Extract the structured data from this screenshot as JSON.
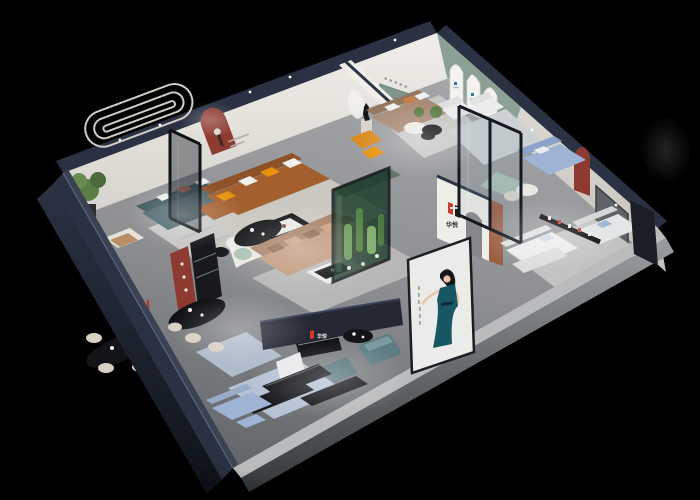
{
  "scene": {
    "type": "3d-isometric-cutaway-render",
    "subject": "furniture showroom dollhouse view on black background",
    "background": "#000000"
  },
  "brand": {
    "mark": "H",
    "name": "华悦",
    "mark_red": "#cf3a30",
    "mark_black": "#1a1a1a"
  },
  "poster": {
    "subject_icon": "woman-in-teal-dress-poster"
  },
  "palette": {
    "bg": "#000000",
    "navy-wall": "#2a3143",
    "navy-dark": "#10141d",
    "navy-light": "#3a4254",
    "ext-gray": "#8e9194",
    "wall-white": "#efece7",
    "wall-shade": "#d8d5cf",
    "sage-wall": "#8ba193",
    "floor-light": "#a6a8aa",
    "floor-dark": "#686b6e",
    "rug": "#c7c8c6",
    "rug-blue": "#b6c3d5",
    "sofa-brown": "#a35f2e",
    "sofa-tan": "#c0977b",
    "sofa-teal": "#4c666d",
    "sofa-white": "#ececee",
    "sofa-blue": "#9fb3d4",
    "mint": "#a9c0b2",
    "orange": "#e8920f",
    "maroon": "#8e3a31",
    "logo-red": "#cf3a30",
    "plant": "#5c7d46",
    "terrarium": "#1a3a28",
    "black-furniture": "#131417",
    "cream": "#d8d0c2",
    "poster-bg": "#ebebe9",
    "dress-teal": "#175763",
    "skin": "#eac3a6"
  }
}
